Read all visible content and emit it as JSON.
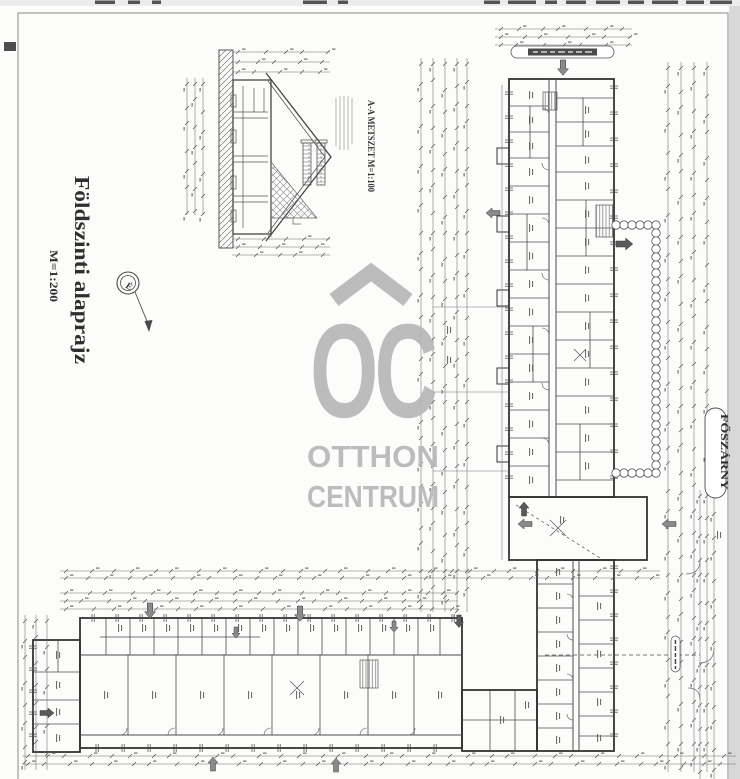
{
  "document": {
    "title": "Földszinti alaprajz",
    "scale": "M=1:200",
    "section_label": "A-A METSZET M=1:100",
    "main_wing_label": "FŐSZÁRNY",
    "compass_label": "É"
  },
  "watermark": {
    "logo_text": "OC",
    "line1": "OTTHON",
    "line2": "CENTRUM",
    "color": "#b7b7b7"
  },
  "icons": {
    "compass": "north-compass-icon",
    "entrance": "entrance-arrow-icon"
  },
  "colors": {
    "paper": "#fcfcfb",
    "ink": "#3c3c3c",
    "chain_line": "#6b6b6b",
    "arrow_gray": "#8a8a8a",
    "scan_edge": "#d8d8d8",
    "capsule_bar": "#4a4a4a"
  }
}
